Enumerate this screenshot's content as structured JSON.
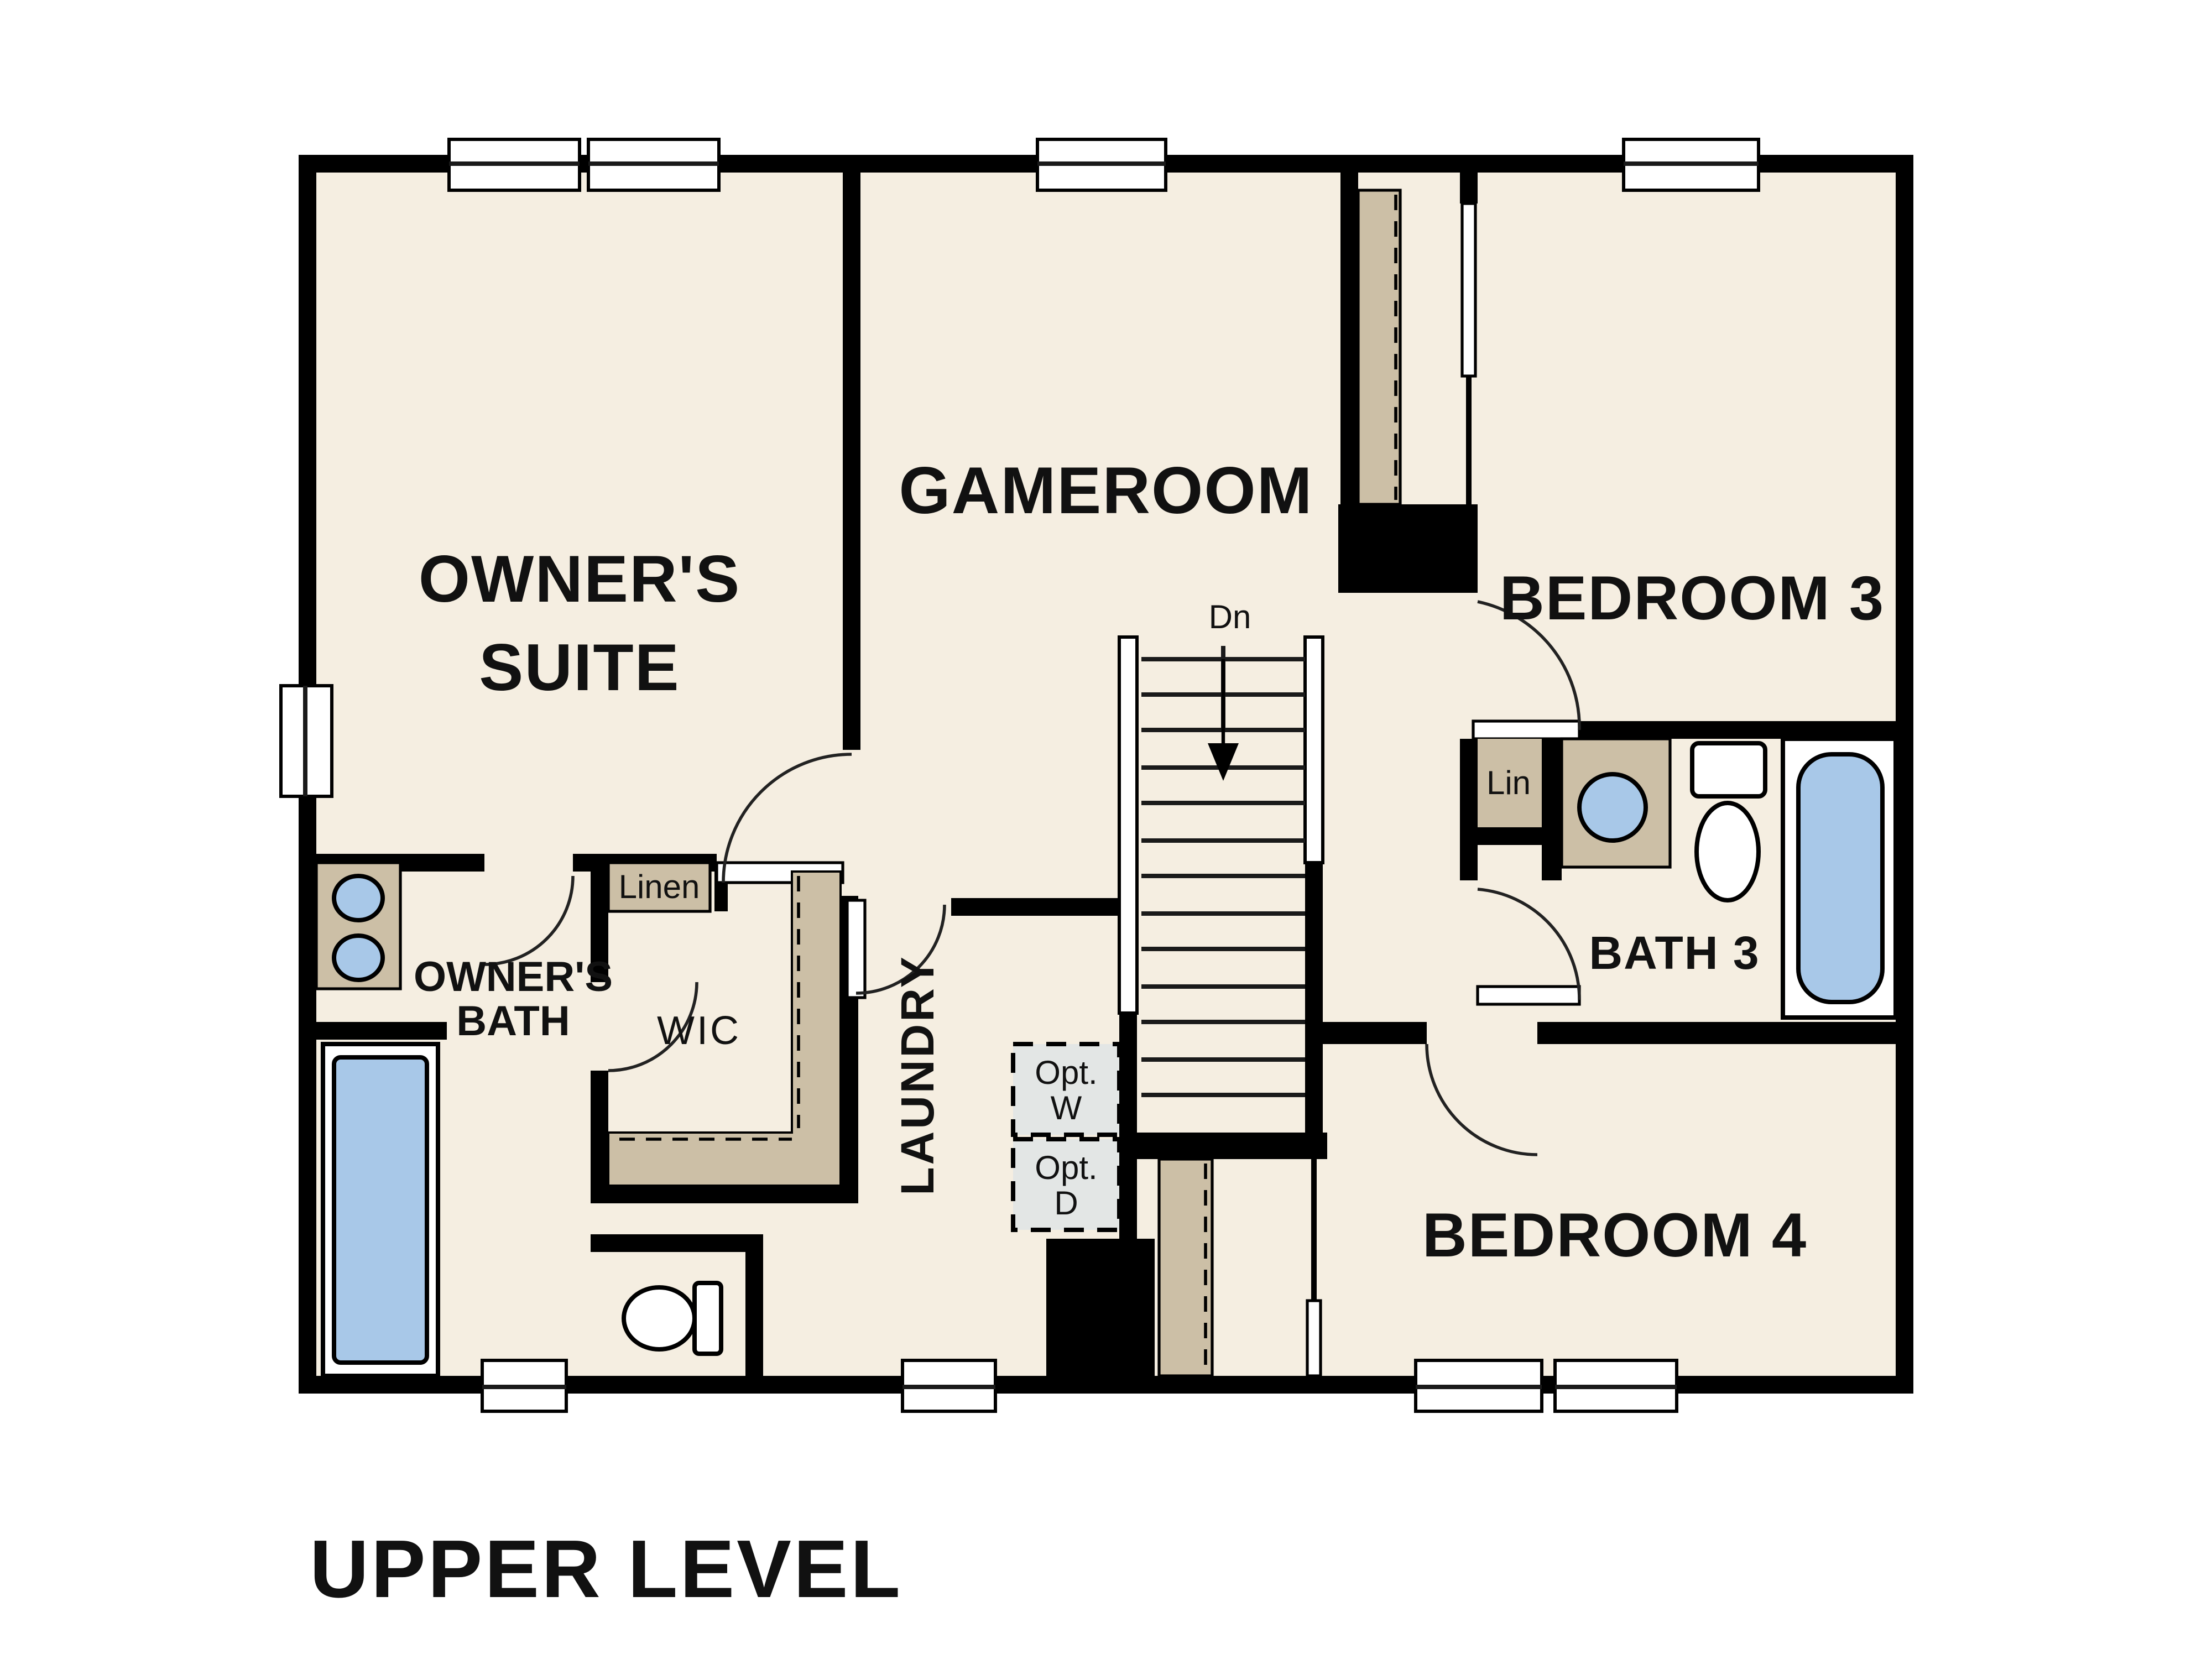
{
  "title": "UPPER LEVEL",
  "rooms": {
    "owners_suite": {
      "line1": "OWNER'S",
      "line2": "SUITE"
    },
    "gameroom": {
      "label": "GAMEROOM"
    },
    "bedroom3": {
      "label": "BEDROOM 3"
    },
    "bath3": {
      "label": "BATH 3"
    },
    "bedroom4": {
      "label": "BEDROOM 4"
    },
    "owners_bath": {
      "line1": "OWNER'S",
      "line2": "BATH"
    },
    "laundry": {
      "label": "LAUNDRY"
    },
    "wic": {
      "label": "WIC"
    }
  },
  "closets": {
    "linen": "Linen",
    "lin": "Lin"
  },
  "stairs": {
    "direction_label": "Dn"
  },
  "optional_appliances": {
    "washer": {
      "line1": "Opt.",
      "line2": "W"
    },
    "dryer": {
      "line1": "Opt.",
      "line2": "D"
    }
  },
  "colors": {
    "wall": "#000000",
    "floor": "#f5eee1",
    "cabinetry_tan": "#ccbfa6",
    "fixture_blue": "#a8c8e8",
    "optional_appliance_gray": "#e3e6e5",
    "background": "#ffffff"
  }
}
